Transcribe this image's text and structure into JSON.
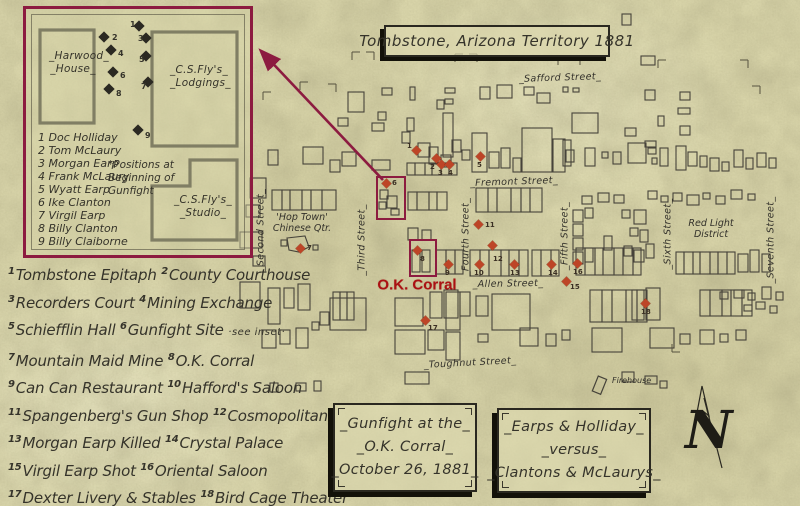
{
  "title": "Tombstone, Arizona Territory 1881",
  "colors": {
    "parchment": "#d8d4a9",
    "ink": "#35332a",
    "accent_maroon": "#8c1b40",
    "marker_red": "#bd4527",
    "okc_red": "#ab1113"
  },
  "okc_label": "O.K. Corral",
  "inset": {
    "buildings": {
      "harwood": [
        "_Harwood_",
        "_House_"
      ],
      "lodgings": [
        "_C.S.Fly's_",
        "_Lodgings_"
      ],
      "studio": [
        "_C.S.Fly's_",
        "_Studio_"
      ]
    },
    "note": "*Positions at\nBeginning of\nGunfight",
    "roster": [
      {
        "n": "1",
        "name": "Doc Holliday"
      },
      {
        "n": "2",
        "name": "Tom McLaury"
      },
      {
        "n": "3",
        "name": "Morgan Earp"
      },
      {
        "n": "4",
        "name": "Frank McLaury"
      },
      {
        "n": "5",
        "name": "Wyatt Earp"
      },
      {
        "n": "6",
        "name": "Ike Clanton"
      },
      {
        "n": "7",
        "name": "Virgil Earp"
      },
      {
        "n": "8",
        "name": "Billy Clanton"
      },
      {
        "n": "9",
        "name": "Billy Claiborne"
      }
    ],
    "markers": [
      {
        "n": "1",
        "x": 113,
        "y": 17,
        "lx": 104,
        "ly": 11
      },
      {
        "n": "2",
        "x": 78,
        "y": 28,
        "lx": 86,
        "ly": 24
      },
      {
        "n": "3",
        "x": 120,
        "y": 29,
        "lx": 112,
        "ly": 25
      },
      {
        "n": "4",
        "x": 85,
        "y": 41,
        "lx": 92,
        "ly": 40
      },
      {
        "n": "5",
        "x": 120,
        "y": 47,
        "lx": 113,
        "ly": 46
      },
      {
        "n": "6",
        "x": 87,
        "y": 63,
        "lx": 94,
        "ly": 62
      },
      {
        "n": "7",
        "x": 122,
        "y": 73,
        "lx": 115,
        "ly": 73
      },
      {
        "n": "8",
        "x": 83,
        "y": 80,
        "lx": 90,
        "ly": 80
      },
      {
        "n": "9",
        "x": 112,
        "y": 121,
        "lx": 119,
        "ly": 122
      }
    ]
  },
  "legend": [
    [
      {
        "n": "1",
        "t": "Tombstone Epitaph"
      },
      {
        "n": "2",
        "t": "County Courthouse"
      }
    ],
    [
      {
        "n": "3",
        "t": "Recorders Court"
      },
      {
        "n": "4",
        "t": "Mining Exchange"
      }
    ],
    [
      {
        "n": "5",
        "t": "Schiefflin Hall"
      },
      {
        "n": "6",
        "t": "Gunfight Site",
        "s": "·see inset·"
      }
    ],
    [
      {
        "n": "7",
        "t": "Mountain Maid Mine"
      },
      {
        "n": "8",
        "t": "O.K. Corral"
      }
    ],
    [
      {
        "n": "9",
        "t": "Can Can Restaurant"
      },
      {
        "n": "10",
        "t": "Hafford's Saloon"
      }
    ],
    [
      {
        "n": "11",
        "t": "Spangenberg's Gun Shop"
      },
      {
        "n": "12",
        "t": "Cosmopolitan"
      }
    ],
    [
      {
        "n": "13",
        "t": "Morgan Earp Killed"
      },
      {
        "n": "14",
        "t": "Crystal Palace"
      }
    ],
    [
      {
        "n": "15",
        "t": "Virgil Earp Shot"
      },
      {
        "n": "16",
        "t": "Oriental Saloon"
      }
    ],
    [
      {
        "n": "17",
        "t": "Dexter Livery & Stables"
      },
      {
        "n": "18",
        "t": "Bird Cage Theater"
      }
    ]
  ],
  "streets": {
    "horizontal": [
      {
        "name": "_Safford Street_",
        "x": 560,
        "y": 78,
        "rot": -2
      },
      {
        "name": "_Fremont Street_",
        "x": 514,
        "y": 182,
        "rot": -2
      },
      {
        "name": "_Allen Street_",
        "x": 508,
        "y": 284,
        "rot": -1
      },
      {
        "name": "_Toughnut Street_",
        "x": 470,
        "y": 363,
        "rot": -3
      }
    ],
    "vertical": [
      {
        "name": "_Second Street_",
        "x": 261,
        "y": 230
      },
      {
        "name": "_Third Street_",
        "x": 362,
        "y": 240
      },
      {
        "name": "_Fourth Street_",
        "x": 466,
        "y": 237
      },
      {
        "name": "_Fifth Street_",
        "x": 565,
        "y": 236
      },
      {
        "name": "_Sixth Street_",
        "x": 668,
        "y": 234
      },
      {
        "name": "_Seventh Street_",
        "x": 771,
        "y": 240
      }
    ]
  },
  "area_labels": [
    {
      "id": "hoptown",
      "text": "'Hop Town'\nChinese Qtr.",
      "x": 302,
      "y": 223
    },
    {
      "id": "redlight",
      "text": "Red Light\nDistrict",
      "x": 711,
      "y": 229
    }
  ],
  "firehouse_label": "Firehouse",
  "map_markers": [
    {
      "n": "1",
      "x": 416,
      "y": 150,
      "lx": 407,
      "ly": 142
    },
    {
      "n": "2",
      "x": 436,
      "y": 158,
      "lx": 430,
      "ly": 163
    },
    {
      "n": "3",
      "x": 441,
      "y": 164,
      "lx": 438,
      "ly": 169
    },
    {
      "n": "4",
      "x": 449,
      "y": 164,
      "lx": 448,
      "ly": 169
    },
    {
      "n": "5",
      "x": 480,
      "y": 156,
      "lx": 477,
      "ly": 161
    },
    {
      "n": "6",
      "x": 386,
      "y": 183,
      "lx": 392,
      "ly": 179
    },
    {
      "n": "7",
      "x": 300,
      "y": 248,
      "lx": 307,
      "ly": 244
    },
    {
      "n": "8",
      "x": 417,
      "y": 250,
      "lx": 420,
      "ly": 255
    },
    {
      "n": "9",
      "x": 448,
      "y": 264,
      "lx": 445,
      "ly": 269
    },
    {
      "n": "10",
      "x": 479,
      "y": 264,
      "lx": 474,
      "ly": 269
    },
    {
      "n": "11",
      "x": 478,
      "y": 224,
      "lx": 485,
      "ly": 221
    },
    {
      "n": "12",
      "x": 492,
      "y": 245,
      "lx": 493,
      "ly": 255
    },
    {
      "n": "13",
      "x": 514,
      "y": 264,
      "lx": 510,
      "ly": 269
    },
    {
      "n": "14",
      "x": 551,
      "y": 264,
      "lx": 548,
      "ly": 269
    },
    {
      "n": "15",
      "x": 566,
      "y": 281,
      "lx": 570,
      "ly": 283
    },
    {
      "n": "16",
      "x": 577,
      "y": 263,
      "lx": 573,
      "ly": 268
    },
    {
      "n": "17",
      "x": 425,
      "y": 320,
      "lx": 428,
      "ly": 324
    },
    {
      "n": "18",
      "x": 645,
      "y": 303,
      "lx": 641,
      "ly": 308
    }
  ],
  "boxes": {
    "gunfight": {
      "lines": [
        "_Gunfight at the_",
        "_O.K. Corral_",
        "_October 26, 1881_"
      ]
    },
    "versus": {
      "lines": [
        "_Earps & Holliday_",
        "_versus_",
        "_Clantons & McLaurys_"
      ]
    }
  },
  "compass": {
    "letter": "N"
  }
}
